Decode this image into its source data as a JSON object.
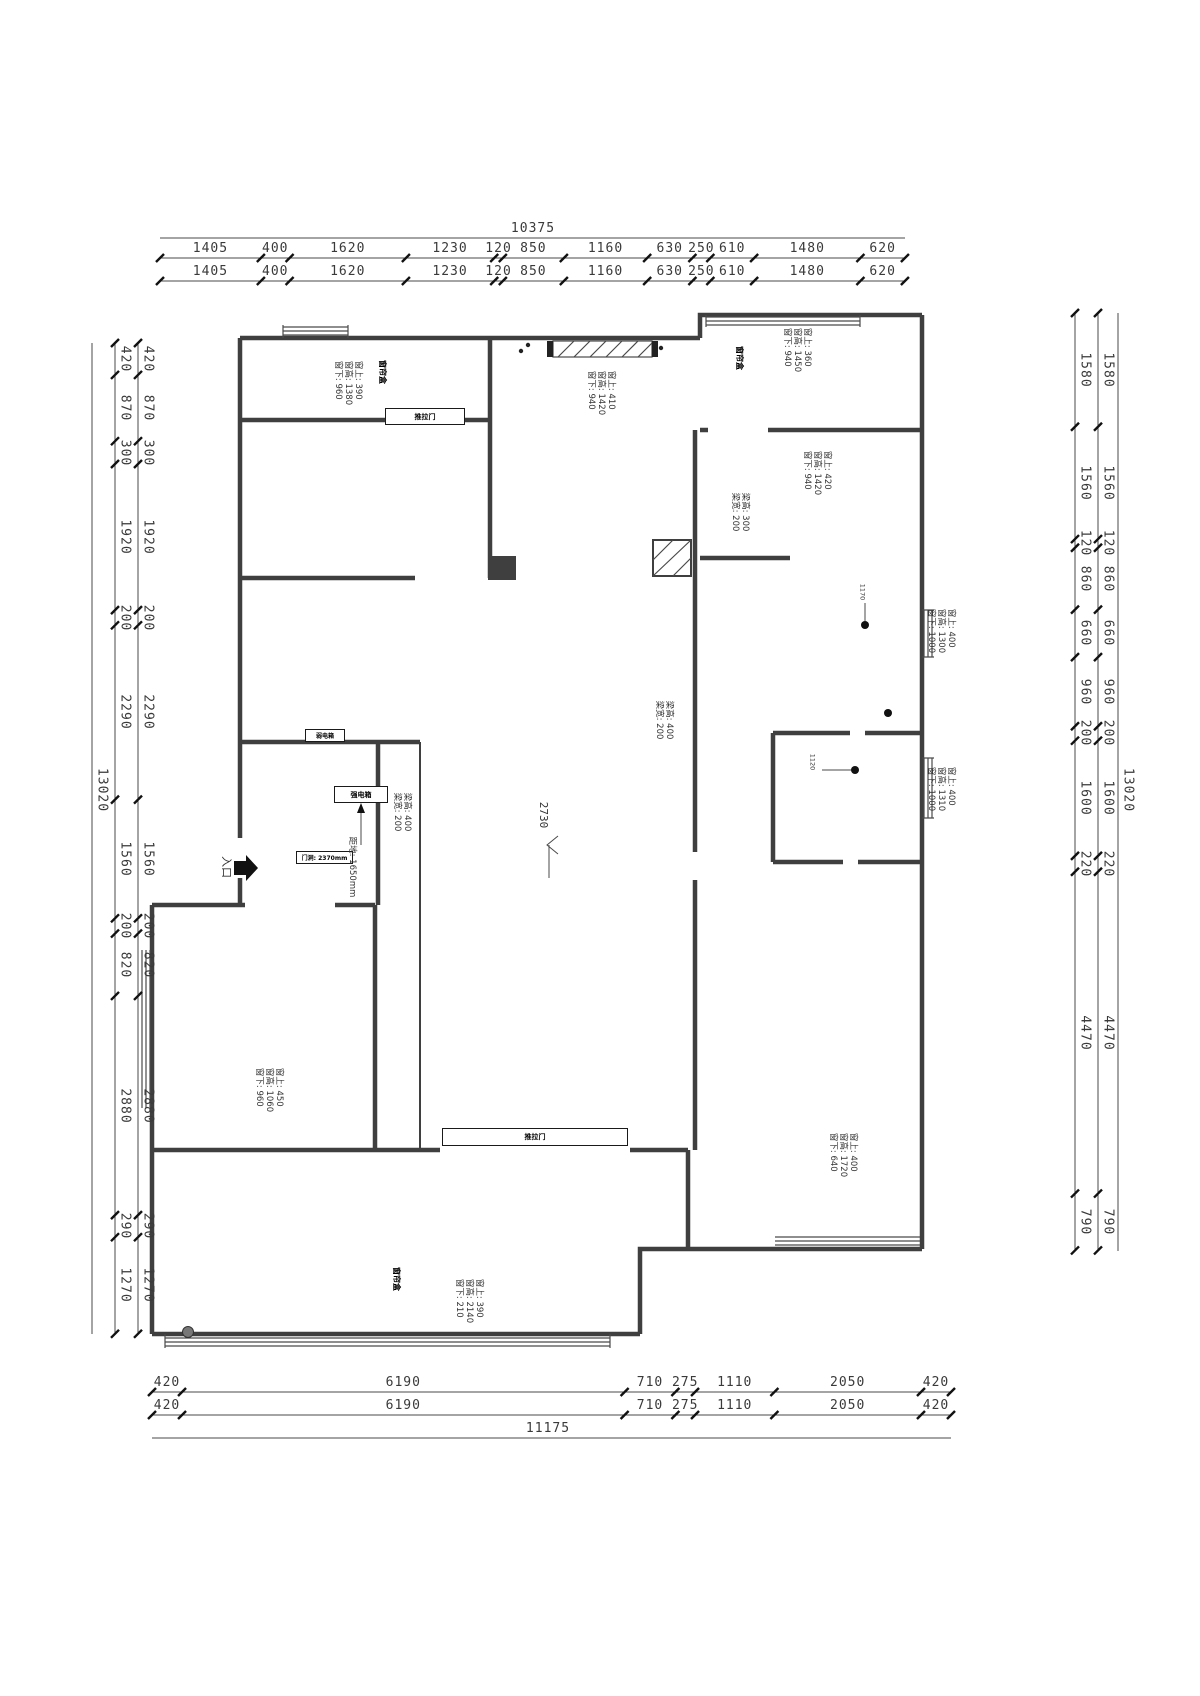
{
  "dims": {
    "top": {
      "total": "10375",
      "values": [
        "1405",
        "400",
        "1620",
        "1230",
        "120",
        "850",
        "1160",
        "630",
        "250",
        "610",
        "1480",
        "620"
      ]
    },
    "bottom": {
      "total": "11175",
      "values": [
        "420",
        "6190",
        "710",
        "275",
        "1110",
        "2050",
        "420"
      ]
    },
    "left": {
      "total": "13020",
      "values": [
        "420",
        "870",
        "300",
        "1920",
        "200",
        "2290",
        "1560",
        "200",
        "820",
        "2880",
        "290",
        "1270"
      ]
    },
    "right": {
      "total": "13020",
      "values": [
        "1580",
        "1560",
        "120",
        "860",
        "660",
        "960",
        "200",
        "1600",
        "220",
        "4470",
        "790"
      ]
    }
  },
  "annotations": {
    "tl_window": [
      "窗上: 390",
      "窗高: 1380",
      "窗下: 960"
    ],
    "tm_window": [
      "窗上: 410",
      "窗高: 1420",
      "窗下: 940"
    ],
    "tr_window": [
      "窗上: 360",
      "窗高: 1450",
      "窗下: 940"
    ],
    "r1_window": [
      "窗上: 420",
      "窗高: 1420",
      "窗下: 940"
    ],
    "rm1_window": [
      "窗上: 400",
      "窗高: 1300",
      "窗下: 1000"
    ],
    "rm2_window": [
      "窗上: 400",
      "窗高: 1310",
      "窗下: 1000"
    ],
    "bl_window": [
      "窗上: 450",
      "窗高: 1060",
      "窗下: 960"
    ],
    "b_window": [
      "窗上: 390",
      "窗高: 2140",
      "窗下: 210"
    ],
    "br_window": [
      "窗上: 400",
      "窗高: 1720",
      "窗下: 640"
    ],
    "beam_bath": [
      "梁高: 300",
      "梁宽: 200"
    ],
    "beam_center_right": [
      "梁高: 400",
      "梁宽: 200"
    ],
    "beam_center_left": [
      "梁高: 400",
      "梁宽: 200"
    ],
    "curtain_tl": [
      "窗帘盒"
    ],
    "curtain_tr": [
      "窗帘盒"
    ],
    "curtain_b": [
      "窗帘盒"
    ],
    "above_floor": [
      "距地: 1650mm"
    ],
    "light_dist_1": [
      "1170"
    ],
    "light_dist_2": [
      "1120"
    ],
    "level_mark": [
      "2730"
    ],
    "entrance": [
      "入口"
    ]
  },
  "labels": {
    "door_opening": "门洞: 2370mm",
    "sliding_door_1": "推拉门",
    "sliding_door_2": "推拉门",
    "strong_elec_box": "强电箱",
    "weak_elec_box": "弱电箱"
  }
}
